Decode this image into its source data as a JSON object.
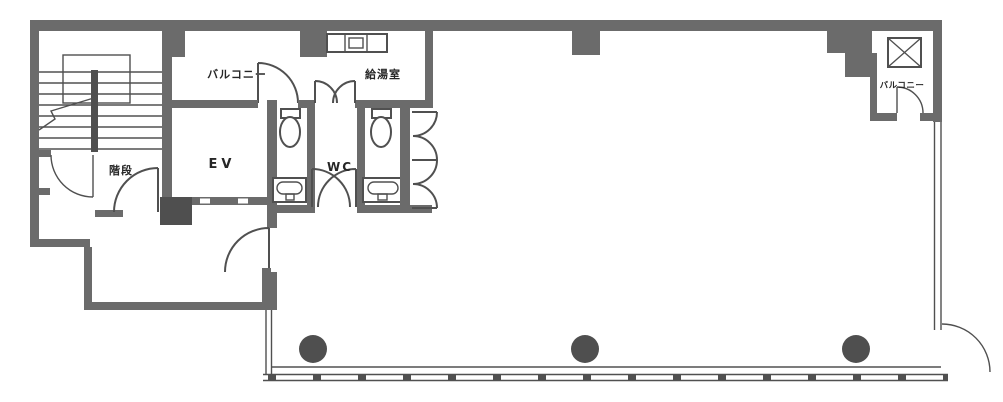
{
  "plan": {
    "title": "building-floor-plan",
    "labels": {
      "balcony_left": "バルコニー",
      "kitchenette": "給湯室",
      "elevator": "EV",
      "toilet": "WC",
      "stairs": "階段",
      "balcony_right": "バルコニー"
    },
    "colors": {
      "wall": "#6b6b6b",
      "line": "#505050",
      "column": "#4f4f4f",
      "background": "#ffffff",
      "text": "#262626"
    },
    "columns_count": 3
  }
}
